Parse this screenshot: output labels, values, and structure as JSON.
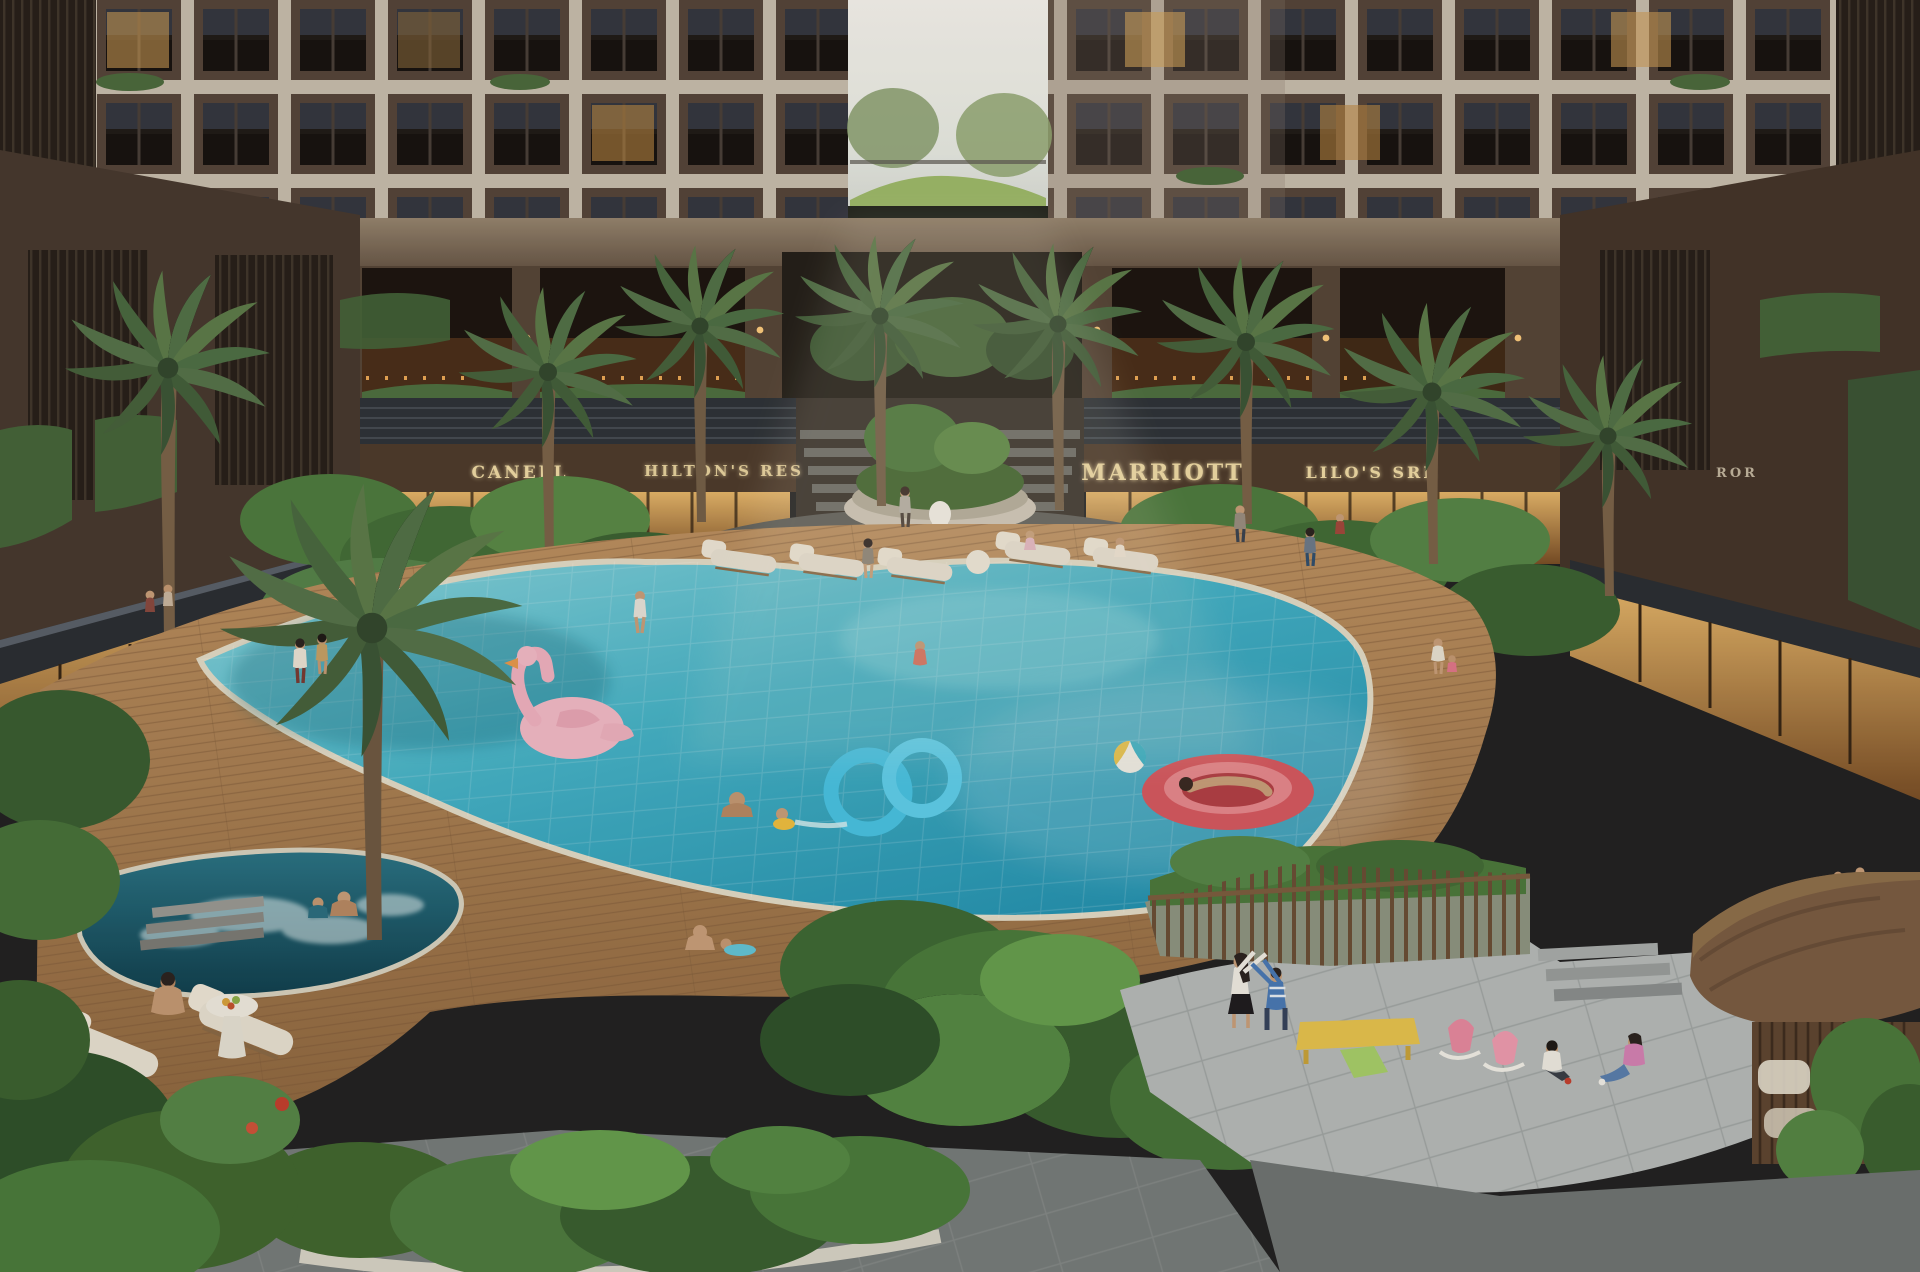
{
  "scene": {
    "title": "Residential complex courtyard with resort pool — dusk architectural rendering",
    "setting": "Inner courtyard of brown apartment towers over a retail podium; tropical landscaping, palm trees, central fountain plaza, freeform turquoise pool with floats, jacuzzi, kids playground and wooden gazebo"
  },
  "signage": [
    {
      "label": "CANELL"
    },
    {
      "label": "HILTON'S RES"
    },
    {
      "label": "MARRIOTT"
    },
    {
      "label": "LILO'S SRE"
    },
    {
      "label": "ROR"
    }
  ],
  "features": [
    "apartment-towers",
    "sky-gap-terrace-garden",
    "retail-arcade",
    "storefronts",
    "central-fountain",
    "circular-mosaic-plaza",
    "palm-trees",
    "tropical-planting",
    "wood-pool-deck",
    "freeform-pool",
    "flamingo-float",
    "double-ring-float",
    "red-boat-float",
    "beach-ball",
    "swimmers",
    "jacuzzi",
    "sun-loungers",
    "fruit-side-table",
    "kids-playground",
    "rocking-toys",
    "play-table",
    "gazebo",
    "stone-pavement",
    "planter-hedge"
  ],
  "palette": {
    "facade_brown": "#55453a",
    "frame_cream": "#cfc5b4",
    "canopy_slate": "#2e3338",
    "sign_gold": "#f2dda6",
    "shop_glow": "#d9a55e",
    "pool_turquoise": "#3fb3c6",
    "pool_deep": "#1f8fae",
    "jacuzzi_teal": "#17505e",
    "deck_wood": "#b08353",
    "foliage_green": "#4e7c3f",
    "palm_green": "#5d7c4a",
    "pavement_grey": "#b7bcba",
    "flamingo_pink": "#f4bcc8",
    "float_red": "#d75a60",
    "ring_blue": "#49c4e4",
    "lounger_cream": "#e9e2d2",
    "sky_light": "#eef0ea"
  }
}
